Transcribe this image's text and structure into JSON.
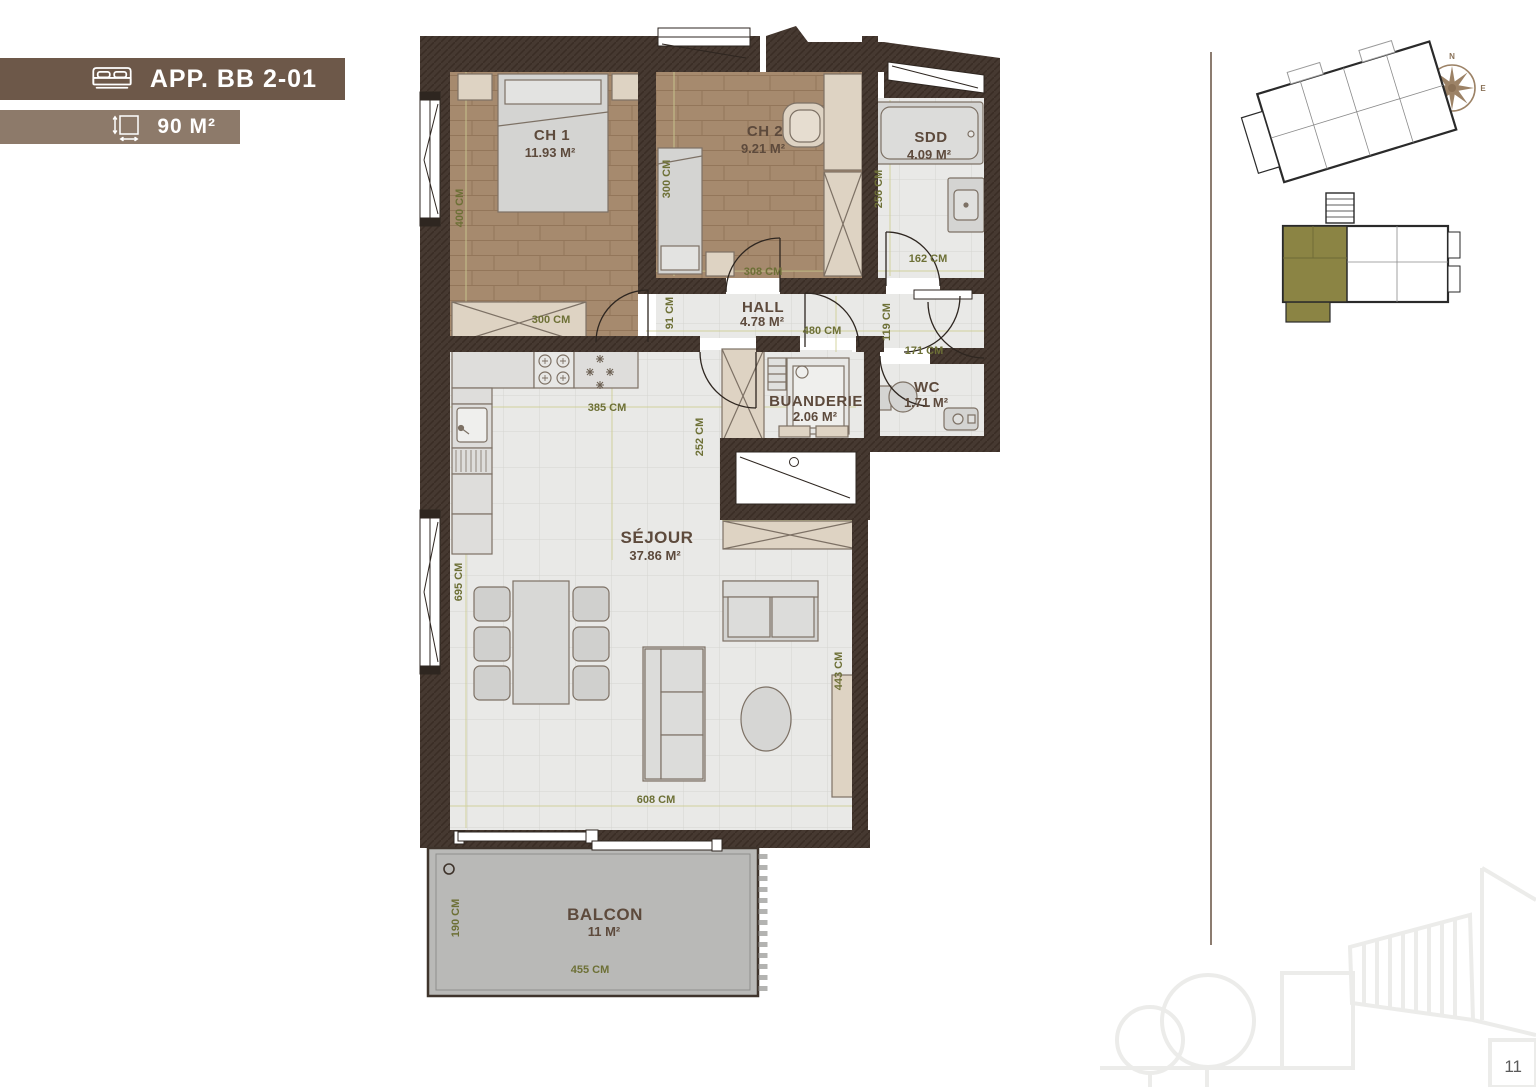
{
  "header": {
    "apartment": "APP. BB 2-01",
    "area": "90 M²"
  },
  "rooms": {
    "ch1": {
      "name": "CH 1",
      "area": "11.93 M²"
    },
    "ch2": {
      "name": "CH 2",
      "area": "9.21 M²"
    },
    "sdd": {
      "name": "SDD",
      "area": "4.09 M²"
    },
    "hall": {
      "name": "HALL",
      "area": "4.78 M²"
    },
    "buanderie": {
      "name": "BUANDERIE",
      "area": "2.06 M²"
    },
    "wc": {
      "name": "WC",
      "area": "1.71 M²"
    },
    "sejour": {
      "name": "SÉJOUR",
      "area": "37.86 M²"
    },
    "balcon": {
      "name": "BALCON",
      "area": "11 M²"
    }
  },
  "dims": {
    "ch1_height": "400 CM",
    "ch1_closet": "300 CM",
    "ch2_height": "300 CM",
    "ch2_width": "308 CM",
    "sdd_height": "256 CM",
    "sdd_width": "162 CM",
    "hall_height": "91 CM",
    "hall_width": "480 CM",
    "entry_height": "119 CM",
    "entry_width": "171 CM",
    "kitchen_width": "385 CM",
    "kitchen_height": "252 CM",
    "sejour_height": "695 CM",
    "sejour_right": "443 CM",
    "sejour_width": "608 CM",
    "balcon_height": "190 CM",
    "balcon_width": "455 CM"
  },
  "compass": {
    "n": "N",
    "e": "E",
    "s": "S",
    "w": "W"
  },
  "page": {
    "number": "11"
  },
  "colors": {
    "badge_dark": "#6d5849",
    "badge_light": "#8d7a6a",
    "wall": "#463931",
    "wood_floor": "#a68a6e",
    "tile_floor": "#e9e9e7",
    "balcony": "#b9b9b7",
    "highlight_olive": "#8b8444",
    "dimension_text": "#6d7036",
    "label_text": "#5d4a3c",
    "compass_brown": "#9c8266"
  }
}
